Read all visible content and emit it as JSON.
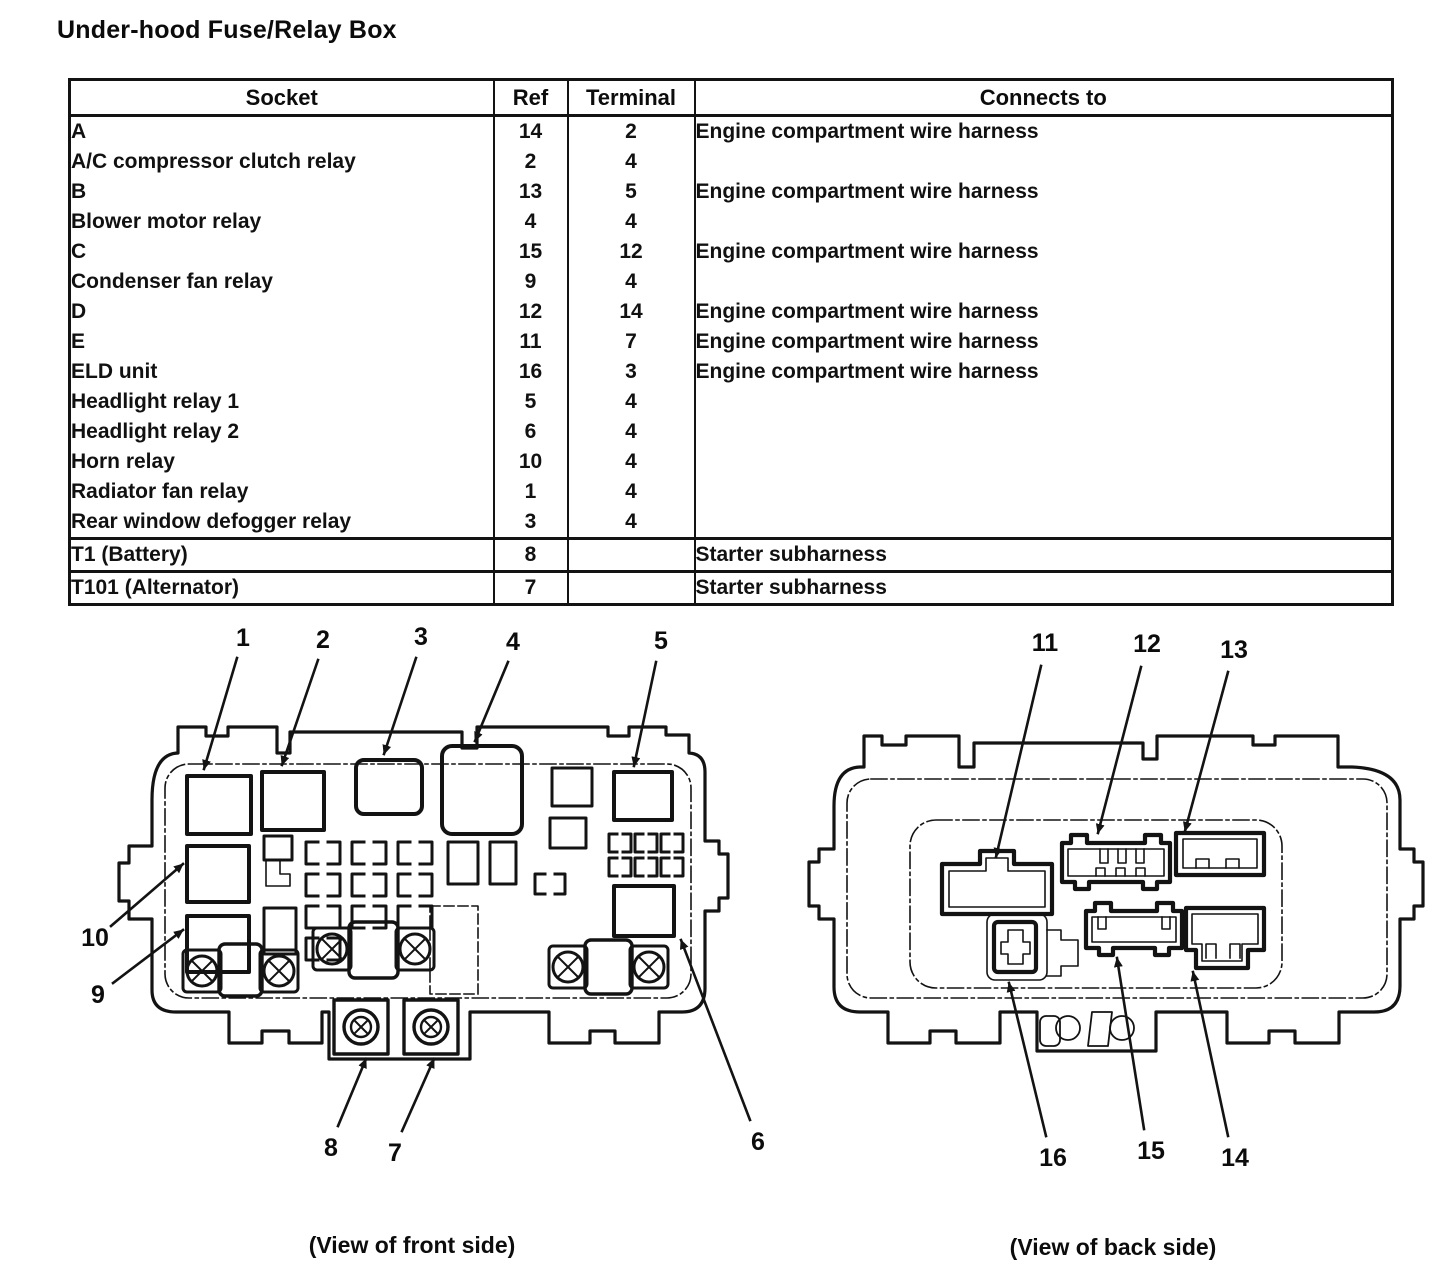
{
  "page": {
    "title": "Under-hood Fuse/Relay Box"
  },
  "table": {
    "headers": [
      "Socket",
      "Ref",
      "Terminal",
      "Connects to"
    ],
    "rows": [
      [
        "A",
        "14",
        "2",
        "Engine compartment wire harness"
      ],
      [
        "A/C compressor clutch relay",
        "2",
        "4",
        ""
      ],
      [
        "B",
        "13",
        "5",
        "Engine compartment wire harness"
      ],
      [
        "Blower motor relay",
        "4",
        "4",
        ""
      ],
      [
        "C",
        "15",
        "12",
        "Engine compartment wire harness"
      ],
      [
        "Condenser fan relay",
        "9",
        "4",
        ""
      ],
      [
        "D",
        "12",
        "14",
        "Engine compartment wire harness"
      ],
      [
        "E",
        "11",
        "7",
        "Engine compartment wire harness"
      ],
      [
        "ELD unit",
        "16",
        "3",
        "Engine compartment wire harness"
      ],
      [
        "Headlight relay 1",
        "5",
        "4",
        ""
      ],
      [
        "Headlight relay 2",
        "6",
        "4",
        ""
      ],
      [
        "Horn relay",
        "10",
        "4",
        ""
      ],
      [
        "Radiator fan relay",
        "1",
        "4",
        ""
      ],
      [
        "Rear window defogger relay",
        "3",
        "4",
        ""
      ]
    ],
    "footer_rows": [
      [
        "T1 (Battery)",
        "8",
        "",
        "Starter subharness"
      ],
      [
        "T101 (Alternator)",
        "7",
        "",
        "Starter subharness"
      ]
    ]
  },
  "front_view": {
    "caption": "(View of front side)",
    "callouts": [
      "1",
      "2",
      "3",
      "4",
      "5",
      "6",
      "7",
      "8",
      "9",
      "10"
    ]
  },
  "back_view": {
    "caption": "(View of back side)",
    "callouts": [
      "11",
      "12",
      "13",
      "14",
      "15",
      "16"
    ]
  },
  "colors": {
    "ink": "#131313",
    "paper": "#ffffff"
  }
}
